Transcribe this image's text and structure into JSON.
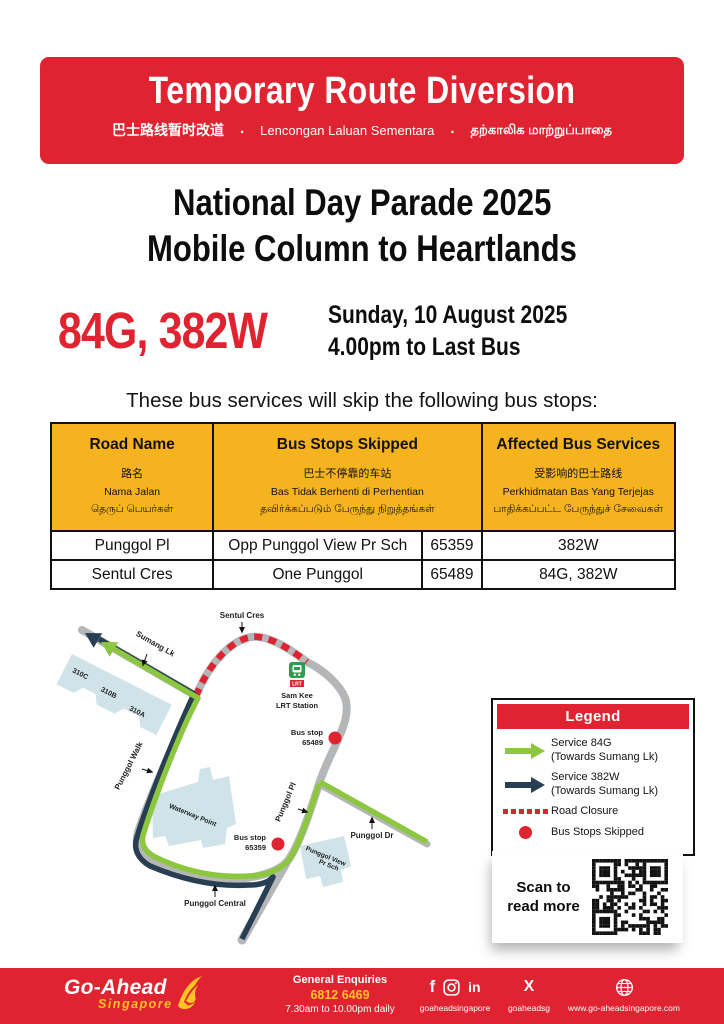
{
  "colors": {
    "red": "#e02330",
    "yellow": "#f5b41f",
    "green": "#8dc63f",
    "navy": "#273e53",
    "road_gray": "#b5b6b8",
    "building_blue": "#cfe3e9",
    "logo_yellow": "#ffc425"
  },
  "banner": {
    "title": "Temporary Route Diversion",
    "subtitle_zh": "巴士路线暂时改道",
    "subtitle_ms": "Lencongan Laluan Sementara",
    "subtitle_ta": "தற்காலிக மாற்றுப்பாதை",
    "separator": "."
  },
  "headline": {
    "line1": "National Day Parade 2025",
    "line2": "Mobile Column to Heartlands"
  },
  "event": {
    "services": "84G, 382W",
    "date": "Sunday, 10 August 2025",
    "time": "4.00pm to Last Bus"
  },
  "intro": "These bus services will skip the following bus stops:",
  "table": {
    "headers": {
      "road": {
        "en": "Road Name",
        "zh": "路名",
        "ms": "Nama Jalan",
        "ta": "தெருப் பெயர்கள்"
      },
      "stops": {
        "en": "Bus Stops Skipped",
        "zh": "巴士不停靠的车站",
        "ms": "Bas Tidak Berhenti di Perhentian",
        "ta": "தவிர்க்கப்படும் பேருந்து நிறுத்தங்கள்"
      },
      "services": {
        "en": "Affected Bus Services",
        "zh": "受影响的巴士路线",
        "ms": "Perkhidmatan Bas Yang Terjejas",
        "ta": "பாதிக்கப்பட்ட பேருந்துச் சேவைகள்"
      }
    },
    "rows": [
      {
        "road": "Punggol Pl",
        "stop": "Opp Punggol View Pr Sch",
        "code": "65359",
        "services": "382W"
      },
      {
        "road": "Sentul Cres",
        "stop": "One Punggol",
        "code": "65489",
        "services": "84G, 382W"
      }
    ]
  },
  "map": {
    "labels": {
      "sentul_cres": "Sentul Cres",
      "sumang_lk": "Sumang Lk",
      "punggol_walk": "Punggol Walk",
      "punggol_pl": "Punggol Pl",
      "punggol_dr": "Punggol Dr",
      "punggol_central": "Punggol Central",
      "waterway_point": "Waterway Point",
      "punggol_view": "Punggol View",
      "pr_sch": "Pr Sch",
      "blk_310c": "310C",
      "blk_310b": "310B",
      "blk_310a": "310A",
      "sam_kee_1": "Sam Kee",
      "sam_kee_2": "LRT Station",
      "lrt_tag": "LRT",
      "bus_stop_1_label": "Bus stop",
      "bus_stop_1_code": "65489",
      "bus_stop_2_label": "Bus stop",
      "bus_stop_2_code": "65359"
    }
  },
  "legend": {
    "title": "Legend",
    "items": [
      {
        "line1": "Service 84G",
        "line2": "(Towards Sumang Lk)"
      },
      {
        "line1": "Service 382W",
        "line2": "(Towards Sumang Lk)"
      },
      {
        "line1": "Road Closure",
        "line2": ""
      },
      {
        "line1": "Bus Stops Skipped",
        "line2": ""
      }
    ]
  },
  "qr": {
    "line1": "Scan to",
    "line2": "read more"
  },
  "footer": {
    "logo_line1": "Go-Ahead",
    "logo_line2": "Singapore",
    "enquiries_title": "General Enquiries",
    "enquiries_phone": "6812 6469",
    "enquiries_hours": "7.30am to 10.00pm daily",
    "facebook_icon": "f",
    "linkedin_icon": "in",
    "x_icon": "X",
    "social_handle": "goaheadsingapore",
    "x_handle": "goaheadsg",
    "website": "www.go-aheadsingapore.com"
  }
}
